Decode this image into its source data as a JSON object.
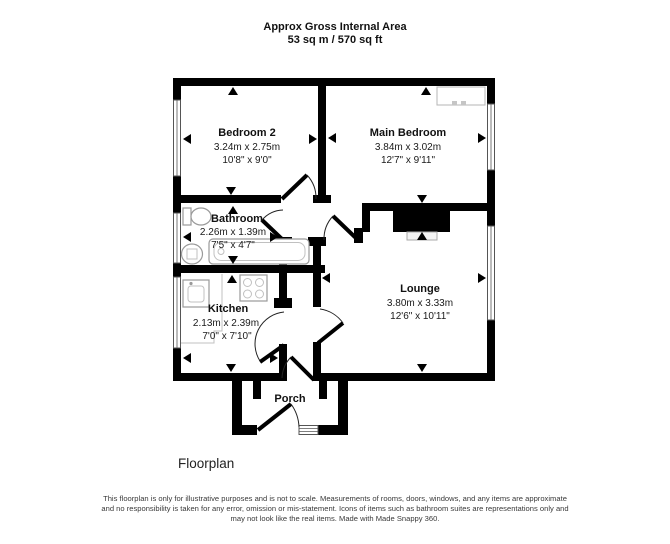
{
  "header": {
    "line1": "Approx Gross Internal Area",
    "line2": "53 sq m / 570 sq ft"
  },
  "rooms": {
    "bedroom2": {
      "name": "Bedroom 2",
      "metric": "3.24m x 2.75m",
      "imperial": "10'8\" x 9'0\""
    },
    "main_bedroom": {
      "name": "Main Bedroom",
      "metric": "3.84m x 3.02m",
      "imperial": "12'7\" x 9'11\""
    },
    "bathroom": {
      "name": "Bathroom",
      "metric": "2.26m x 1.39m",
      "imperial": "7'5\" x 4'7\""
    },
    "kitchen": {
      "name": "Kitchen",
      "metric": "2.13m x 2.39m",
      "imperial": "7'0\" x 7'10\""
    },
    "lounge": {
      "name": "Lounge",
      "metric": "3.80m x 3.33m",
      "imperial": "12'6\" x 10'11\""
    },
    "porch": {
      "name": "Porch"
    }
  },
  "footer": {
    "caption": "Floorplan"
  },
  "disclaimer": {
    "line1": "This floorplan is only for illustrative purposes and is not to scale. Measurements of rooms, doors, windows, and any items are approximate",
    "line2": "and no responsibility is taken for any error, omission or mis-statement. Icons of items such as bathroom suites are representations only and",
    "line3": "may not look like the real items. Made with Made Snappy 360."
  },
  "colors": {
    "wall": "#000000",
    "background": "#ffffff",
    "fixture_outline": "#9a9a9a",
    "text": "#111111"
  }
}
